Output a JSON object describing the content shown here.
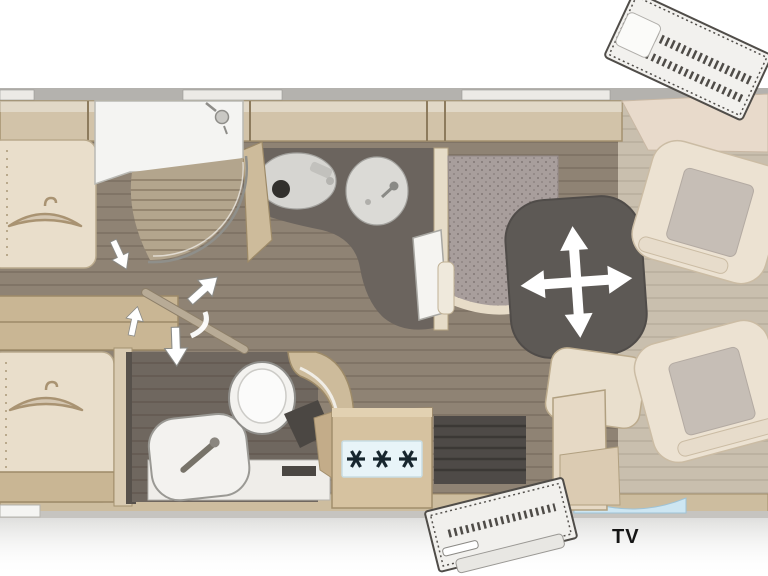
{
  "title": "Motorhome floor plan",
  "labels": {
    "tv": "TV"
  },
  "icons": {
    "hanger_icon": "clothes-hanger",
    "shower_head_icon": "shower-head",
    "burner_icon": "✳",
    "burner_count": 3,
    "table_move_icon": "four-way-arrows",
    "swing_door_icon": "swing-arrow-pair",
    "direction_arrow_icon": "white-outline-arrow"
  },
  "colors": {
    "background": "#ffffff",
    "outer_wall_gray": "#b4b2ae",
    "window_light": "#eceae6",
    "wood_trim": "#d2c3a9",
    "wood_trim_border": "#9c8a68",
    "furniture_cream": "#e9decb",
    "fabric_gray": "#a89e9c",
    "vanity_dark": "#6b645e",
    "table_dark": "#5d5955",
    "floor_wood": "#8f8374",
    "cab_floor": "#c9bfae",
    "bath_floor_dark": "#6f675f",
    "fixture_white": "#f3f2ef",
    "hob_panel_blue": "#e8f4f8",
    "burner_dark": "#17262e",
    "windshield_blue": "#cde6f2",
    "arrow_white": "#ffffff",
    "tv_label_color": "#151515"
  },
  "rooms": [
    {
      "name": "rear-bedroom",
      "features": [
        "single-bed-top",
        "single-bed-bottom",
        "wardrobe-under-bed",
        "step-chest"
      ]
    },
    {
      "name": "shower-room",
      "features": [
        "shower-cubicle",
        "curved-glass-door",
        "slatted-tray"
      ]
    },
    {
      "name": "washroom-vanity",
      "features": [
        "round-basin-left",
        "round-basin-right",
        "open-door"
      ]
    },
    {
      "name": "rear-washroom",
      "features": [
        "toilet",
        "washbasin",
        "curved-wall",
        "entry-arrow"
      ]
    },
    {
      "name": "kitchen",
      "features": [
        "three-burner-hob",
        "counter"
      ]
    },
    {
      "name": "lounge",
      "features": [
        "l-shaped-dinette",
        "movable-table",
        "bench-seat",
        "tv-cabinet"
      ]
    },
    {
      "name": "cab",
      "features": [
        "swivel-seat-front",
        "swivel-seat-rear",
        "dashboard"
      ]
    },
    {
      "name": "entrance",
      "features": [
        "doorway",
        "open-entry-door",
        "open-exterior-door"
      ]
    }
  ]
}
